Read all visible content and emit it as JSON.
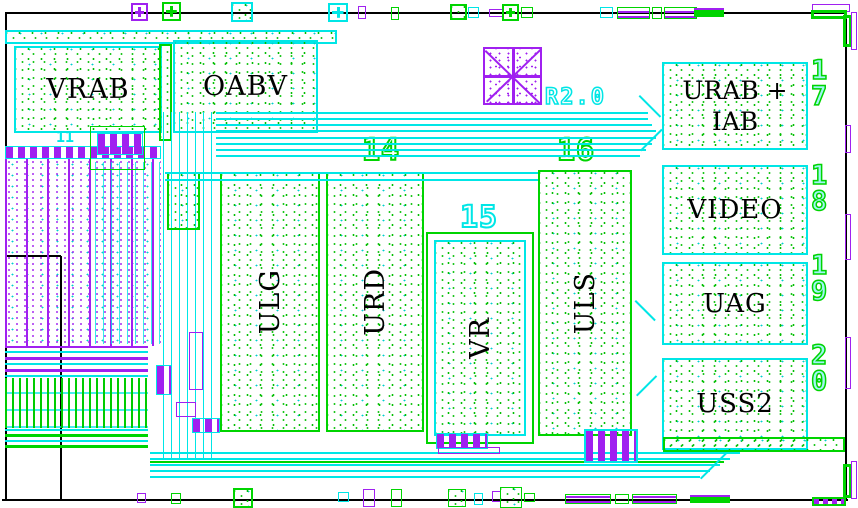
{
  "blocks": {
    "vrab": {
      "label": "VRAB"
    },
    "oabv": {
      "label": "OABV"
    },
    "urab_iab": {
      "line1": "URAB +",
      "line2": "IAB",
      "pad_number": "17"
    },
    "video": {
      "label": "VIDEO",
      "pad_number": "18"
    },
    "uag": {
      "label": "UAG",
      "pad_number": "19"
    },
    "uss2": {
      "label": "USS2",
      "pad_number": "20"
    },
    "ulg": {
      "label": "ULG"
    },
    "urd": {
      "label": "URD"
    },
    "vr": {
      "label": "VR"
    },
    "uls": {
      "label": "ULS"
    }
  },
  "annotations": {
    "revision": "R2.0",
    "num_11": "11",
    "num_14": "14",
    "num_15": "15",
    "num_16": "16"
  },
  "colors": {
    "wire_cyan": "#00E6E6",
    "wire_green": "#00D400",
    "metal_purple": "#A020F0",
    "outline_black": "#000000"
  }
}
